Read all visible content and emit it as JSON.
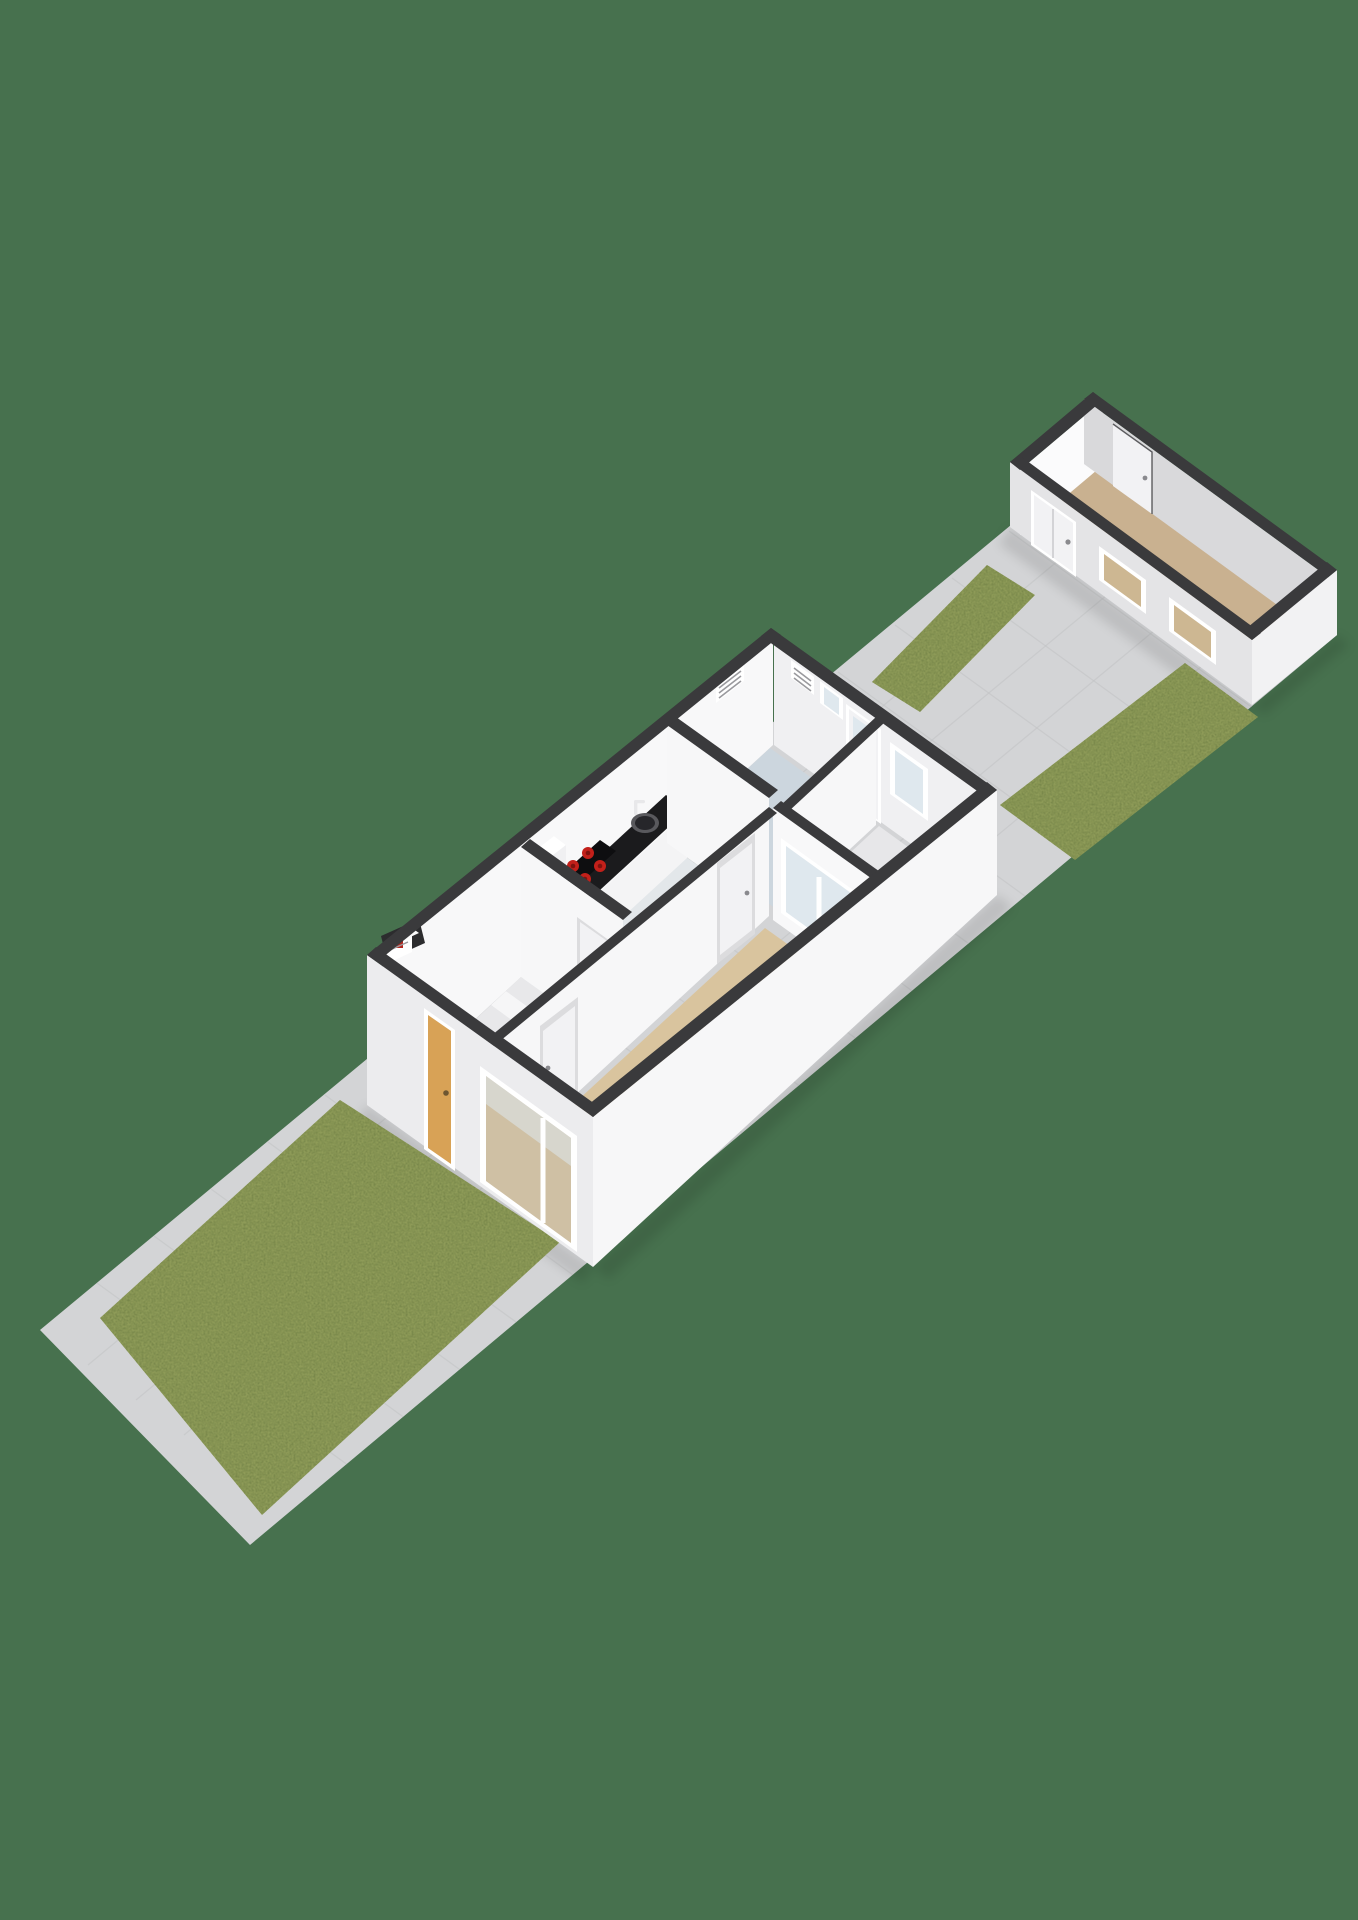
{
  "meta": {
    "app": "3d-floorplan-render",
    "view": "isometric-cutaway-plot-overview",
    "description": "3D isometric cutaway floor plan of a narrow garden plot with front lawn, paved paths, a ground-floor house interior and a detached outbuilding at the rear"
  },
  "colors": {
    "background": "#47714E",
    "path": "#d3d4d6",
    "path_line": "#c2c3c5",
    "grass": "#8e9b58",
    "grass_dark": "#6f7f44",
    "wall_top": "#3a3a3c",
    "wall_front": "#ececee",
    "wall_side": "#f7f7f8",
    "wall_int": "#f8f8f9",
    "wall_int_shade": "#f0f0f2",
    "floor_hall": "#e9e9eb",
    "floor_kitchen": "#e3e7ea",
    "floor_bath": "#ccd6de",
    "floor_backhall": "#e7e7e9",
    "floor_living": "#d9c49e",
    "floor_shed": "#c9b190",
    "counter_top": "#1b1b1d",
    "counter_front": "#f4f4f5",
    "burner": "#c2201a",
    "burner_dark": "#7e120e",
    "door_front": "#d8a256",
    "door_white": "#f2f2f4",
    "frame": "#ffffff",
    "glass": "#dfe8ee",
    "stair": "#f6f6f7",
    "stair_alt": "#e8e8ea",
    "stringer": "#2e2e30",
    "shed_wall": "#e4e4e6",
    "shed_end": "#f2f2f3",
    "shed_int": "#d9d9db",
    "shed_int_bright": "#fbfbfc",
    "meter_red": "#b3261e"
  },
  "scene": {
    "plot": {
      "name": "garden-plot",
      "surface": "paved-tiles",
      "orientation": "diagonal sw-ne"
    },
    "front_garden": {
      "name": "front-garden",
      "features": [
        "lawn",
        "paved-path"
      ]
    },
    "house": {
      "name": "main-house",
      "type": "ground-floor-cutaway",
      "rooms": [
        {
          "name": "entrance-hall",
          "features": [
            "front-door",
            "winder-staircase",
            "meter-box"
          ]
        },
        {
          "name": "kitchen",
          "features": [
            "black-counter",
            "sink",
            "cooktop-4-burners",
            "tall-cabinet"
          ]
        },
        {
          "name": "bathroom",
          "features": [
            "vent-grille",
            "high-window"
          ]
        },
        {
          "name": "back-hall",
          "features": [
            "back-door",
            "garden-window",
            "interior-glazed-wall"
          ]
        },
        {
          "name": "living-room",
          "features": [
            "picture-window",
            "sideboard"
          ]
        }
      ]
    },
    "backyard": {
      "name": "backyard",
      "features": [
        "paved-court",
        "lawn-strip-left",
        "lawn-strip-right"
      ]
    },
    "outbuilding": {
      "name": "outbuilding",
      "features": [
        "storage-door",
        "window-1",
        "window-2",
        "rear-inner-door",
        "wood-floor"
      ]
    }
  }
}
